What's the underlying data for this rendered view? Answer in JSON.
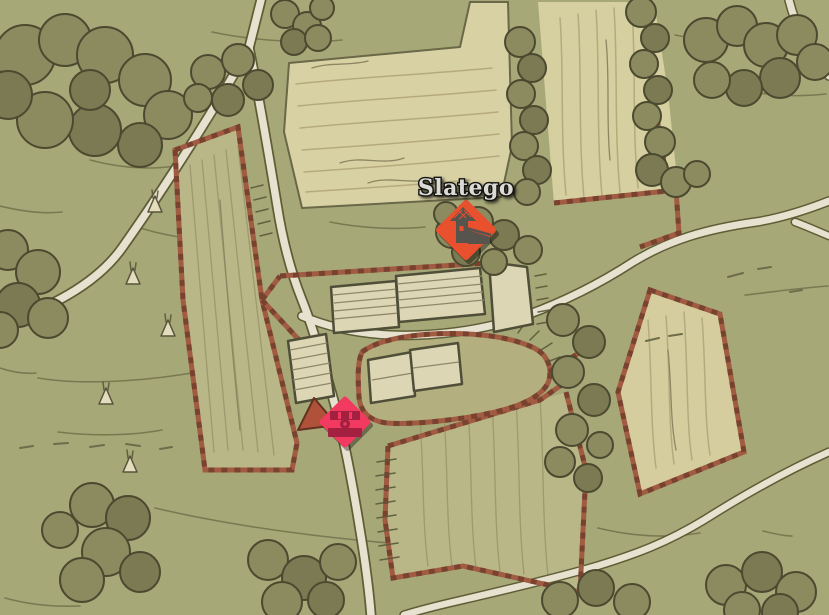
{
  "game_map": {
    "location_label": "Slatego",
    "markers": [
      {
        "name": "slatego-location-marker",
        "icon": "homestead-icon",
        "color": "#e8502e",
        "icon_color": "#57534d"
      },
      {
        "name": "stash-marker",
        "icon": "chest-icon",
        "color": "#f23a60",
        "icon_color": "#a42040"
      }
    ]
  }
}
